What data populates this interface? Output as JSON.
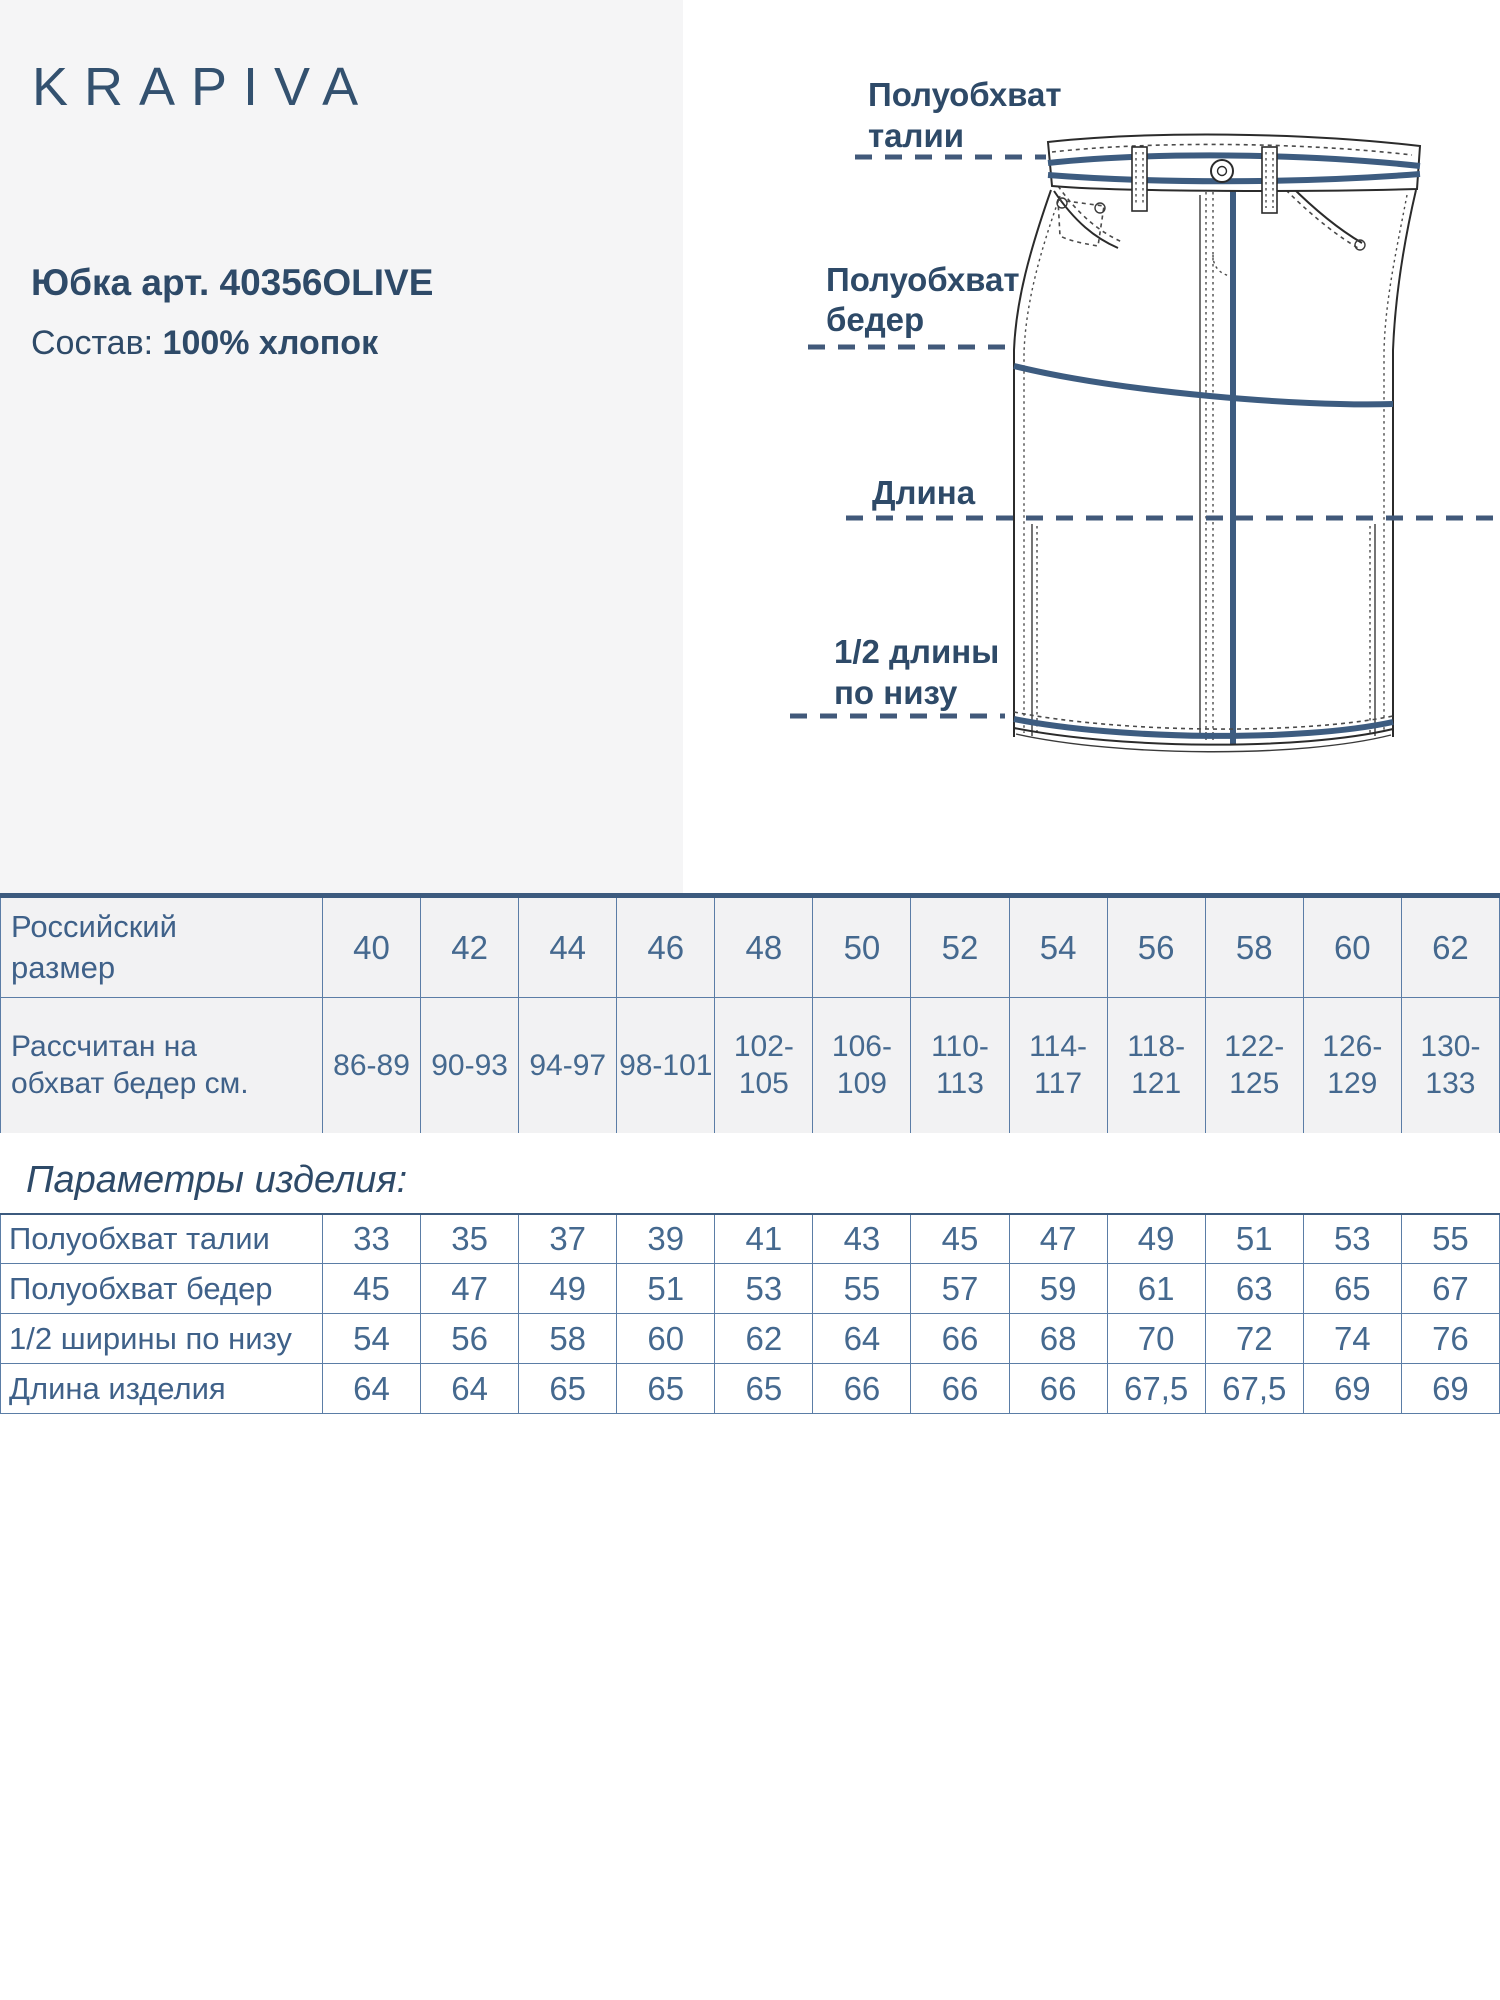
{
  "brand": {
    "logo": "KRAPIVA"
  },
  "product": {
    "title": "Юбка арт. 40356OLIVE",
    "composition_label": "Состав:",
    "composition_value": "100% хлопок"
  },
  "figure": {
    "labels": {
      "waist_1": "Полуобхват",
      "waist_2": "талии",
      "hip_1": "Полуобхват",
      "hip_2": "бедер",
      "length": "Длина",
      "hem_1": "1/2 длины",
      "hem_2": "по низу"
    }
  },
  "size_table": {
    "row1_header": "Российский\nразмер",
    "row2_header": "Рассчитан на\nобхват бедер см.",
    "sizes": [
      "40",
      "42",
      "44",
      "46",
      "48",
      "50",
      "52",
      "54",
      "56",
      "58",
      "60",
      "62"
    ],
    "hip_ranges": [
      "86-89",
      "90-93",
      "94-97",
      "98-101",
      "102-\n105",
      "106-\n109",
      "110-\n113",
      "114-\n117",
      "118-\n121",
      "122-\n125",
      "126-\n129",
      "130-\n133"
    ]
  },
  "params_section": {
    "title": "Параметры изделия:",
    "rows": [
      {
        "label": "Полуобхват талии",
        "values": [
          "33",
          "35",
          "37",
          "39",
          "41",
          "43",
          "45",
          "47",
          "49",
          "51",
          "53",
          "55"
        ]
      },
      {
        "label": "Полуобхват бедер",
        "values": [
          "45",
          "47",
          "49",
          "51",
          "53",
          "55",
          "57",
          "59",
          "61",
          "63",
          "65",
          "67"
        ]
      },
      {
        "label": "1/2 ширины по низу",
        "values": [
          "54",
          "56",
          "58",
          "60",
          "62",
          "64",
          "66",
          "68",
          "70",
          "72",
          "74",
          "76"
        ]
      },
      {
        "label": "Длина изделия",
        "values": [
          "64",
          "64",
          "65",
          "65",
          "65",
          "66",
          "66",
          "66",
          "67,5",
          "67,5",
          "69",
          "69"
        ]
      }
    ]
  },
  "colors": {
    "panel_gray": "#f5f5f6",
    "heading_blue": "#2e4a68",
    "table_text_blue": "#45698f",
    "table_border": "#5b7da6",
    "table_top_border": "#3c5a7e",
    "drawing_accent_blue": "#3d5c80"
  }
}
